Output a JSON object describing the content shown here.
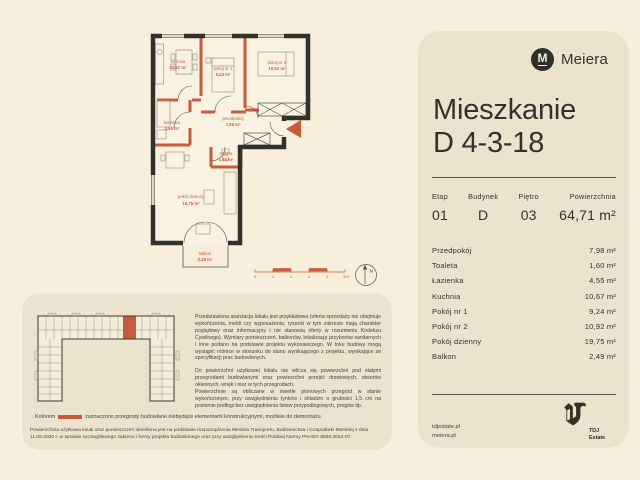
{
  "colors": {
    "background": "#f7efdc",
    "card": "#ebe3cd",
    "ink": "#33322a",
    "accent": "#c75b3d"
  },
  "brand": {
    "name": "Meiera",
    "monogram": "M"
  },
  "apartment": {
    "title_line1": "Mieszkanie",
    "title_line2": "D 4-3-18"
  },
  "summary": {
    "columns": [
      {
        "label": "Etap",
        "value": "01"
      },
      {
        "label": "Budynek",
        "value": "D"
      },
      {
        "label": "Piętro",
        "value": "03"
      },
      {
        "label": "Powierzchnia",
        "value": "64,71 m²"
      }
    ]
  },
  "rooms": [
    {
      "name": "Przedpokój",
      "area": "7,98 m²"
    },
    {
      "name": "Toaleta",
      "area": "1,60 m²"
    },
    {
      "name": "Łazienka",
      "area": "4,55 m²"
    },
    {
      "name": "Kuchnia",
      "area": "10,67 m²"
    },
    {
      "name": "Pokój nr 1",
      "area": "9,24 m²"
    },
    {
      "name": "Pokój nr 2",
      "area": "10,92 m²"
    },
    {
      "name": "Pokój dzienny",
      "area": "19,75 m²"
    },
    {
      "name": "Balkon",
      "area": "2,49 m²"
    }
  ],
  "floorplan": {
    "labels": [
      {
        "name": "kuchnia",
        "area": "10,67 m²"
      },
      {
        "name": "pokój nr 1",
        "area": "9,24 m²"
      },
      {
        "name": "pokój nr 2",
        "area": "10,92 m²"
      },
      {
        "name": "łazienka",
        "area": "4,55 m²"
      },
      {
        "name": "przedpokój",
        "area": "7,98 m²"
      },
      {
        "name": "toaleta",
        "area": "1,60 m²"
      },
      {
        "name": "pokój dzienny",
        "area": "19,75 m²"
      },
      {
        "name": "balkon",
        "area": "2,49 m²"
      }
    ],
    "scale_ticks": [
      "0",
      "1",
      "2",
      "3",
      "4",
      "5m"
    ],
    "compass": "N"
  },
  "disclaimer": {
    "p1": "Przedstawiona aranżacja lokalu jest przykładowa (oferta sprzedaży nie obejmuje wykończenia, mebli czy wyposażenia; rysunki w tym zakresie mają charakter poglądowy oraz informacyjny i nie stanowią oferty w rozumieniu Kodeksu Cywilnego). Wymiary pomieszczeń, balkonów, lokalizację przyborów sanitarnych i inne podano na podstawie projektu wykonawczego. W toku budowy mogą wystąpić różnice w stosunku do stanu wynikającego z projektu, wynikające ze specyfikacji prac budowlanych.",
    "p2": "Do powierzchni użytkowej lokalu nie wlicza się powierzchni pod stałymi przegrodami budowlanymi oraz powierzchni przejść drzwiowych, otworów okiennych, wnęk i nisz w tych przegrodach.",
    "p3": "Powierzchnie są obliczane w świetle pionowych przegród w stanie wykończonym, przy uwzględnieniu tynków i okładzin o grubości 1,5 cm na poziomie podłogi bez uwzględnienia listew przypodłogowych, progów itp."
  },
  "legend": {
    "prefix": "Kolorem",
    "text": "zaznaczono przegrody budowlane niebędące elementami konstrukcyjnymi, możliwe do demontażu."
  },
  "fine_print": "Powierzchnia użytkowa lokali oraz pomieszczeń określona jest na podstawie rozporządzenia Ministra Transportu, Budownictwa i Gospodarki Morskiej z dnia 11.09.2020 r. w sprawie szczegółowego zakresu i formy projektu budowlanego oraz przy uwzględnieniu treści Polskiej Normy PN-ISO 9836:2022-07.",
  "footer": {
    "links": [
      "tdjestate.pl",
      "meiera.pl"
    ],
    "partner": {
      "line1": "TDJ",
      "line2": "Estate"
    }
  }
}
